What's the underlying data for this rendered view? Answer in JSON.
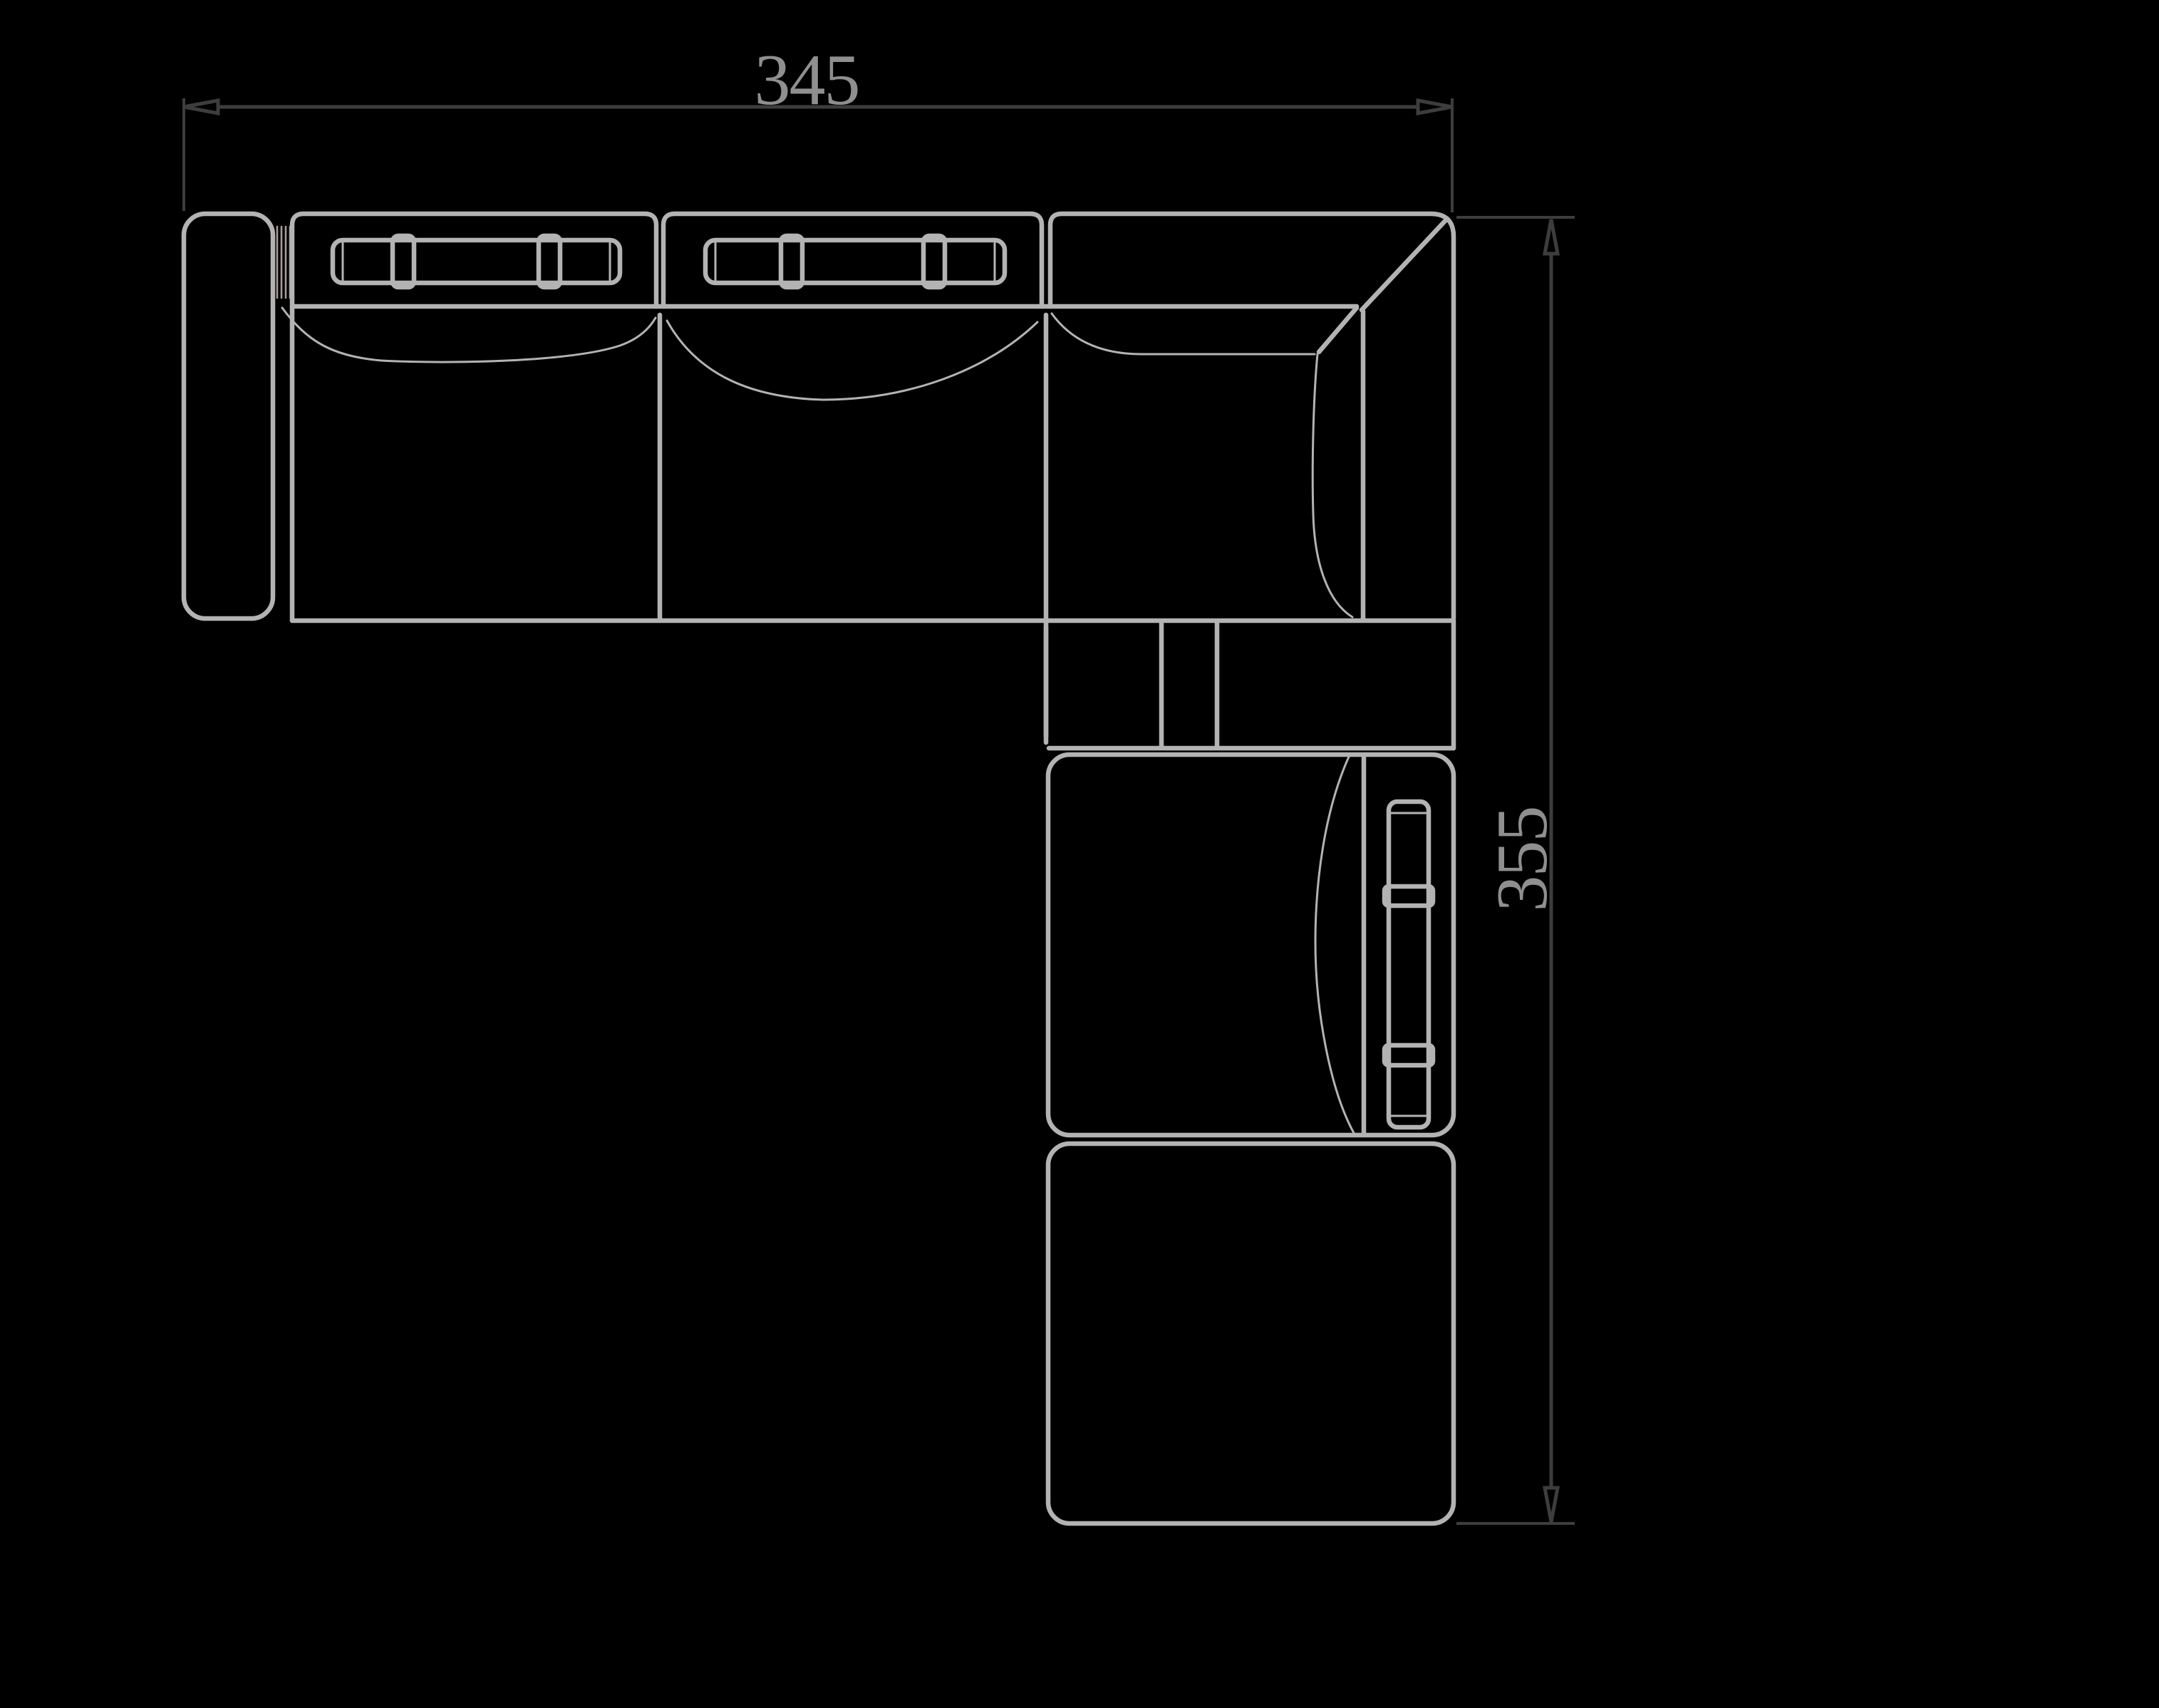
{
  "drawing": {
    "colors": {
      "background": "#000000",
      "furniture_line": "#b3b3b3",
      "hatch_line": "#a79b9b",
      "dimension_line": "#3d3d3d",
      "dimension_text": "#8f8f8f"
    },
    "dimension_width": {
      "value": "345"
    },
    "dimension_height": {
      "value": "355"
    }
  }
}
